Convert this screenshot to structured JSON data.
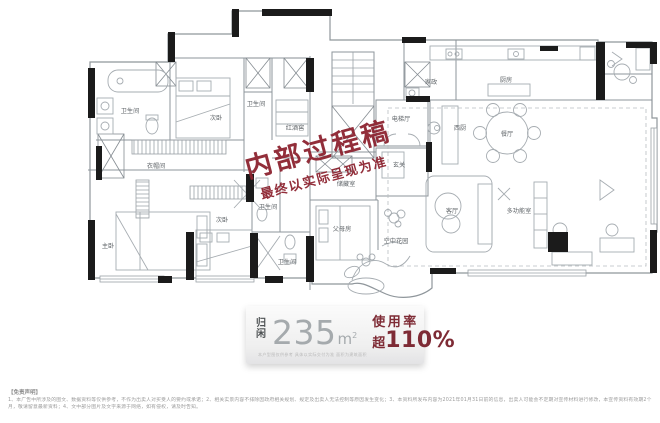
{
  "floorplan": {
    "rooms": [
      {
        "label": "卫生间",
        "x": 130,
        "y": 113
      },
      {
        "label": "次卧",
        "x": 216,
        "y": 120
      },
      {
        "label": "卫生间",
        "x": 256,
        "y": 106
      },
      {
        "label": "红酒窖",
        "x": 295,
        "y": 130
      },
      {
        "label": "电梯厅",
        "x": 401,
        "y": 121
      },
      {
        "label": "家政",
        "x": 431,
        "y": 84
      },
      {
        "label": "厨房",
        "x": 506,
        "y": 82
      },
      {
        "label": "西厨",
        "x": 460,
        "y": 130
      },
      {
        "label": "餐厅",
        "x": 507,
        "y": 136
      },
      {
        "label": "玄关",
        "x": 399,
        "y": 167
      },
      {
        "label": "储藏室",
        "x": 346,
        "y": 186
      },
      {
        "label": "衣帽间",
        "x": 156,
        "y": 168
      },
      {
        "label": "主卧",
        "x": 108,
        "y": 248
      },
      {
        "label": "次卧",
        "x": 222,
        "y": 222
      },
      {
        "label": "卫生间",
        "x": 268,
        "y": 209
      },
      {
        "label": "卫生间",
        "x": 287,
        "y": 264
      },
      {
        "label": "父母房",
        "x": 342,
        "y": 231
      },
      {
        "label": "空中花园",
        "x": 396,
        "y": 243
      },
      {
        "label": "客厅",
        "x": 452,
        "y": 213
      },
      {
        "label": "多功能室",
        "x": 519,
        "y": 213
      }
    ]
  },
  "watermark": {
    "line1": "内部过程稿",
    "line2": "最终以实际呈现为准",
    "color": "#8d2330"
  },
  "badge": {
    "name_vertical": "归闲",
    "area_value": "235",
    "area_unit": "m",
    "area_sup": "2",
    "fine_print": "本户型图仅供参考 具体以实际交付为准 面积为建筑面积",
    "usage_label": "使用率",
    "usage_prefix": "超",
    "usage_value": "110%",
    "accent_color": "#7e2b35"
  },
  "disclaimer": {
    "heading": "【免责声明】",
    "body": "1、本广告中所涉及的图文、数据资料等仅供参考，不作为出卖人对买受人的要约或承诺；2、相关实景内容不排除因政府相关规划、规定及出卖人无法控制等原因发生变化；3、本资料所发布内容为2021年01月31日前的信息，出卖人可能会不定期对宣传材料进行修改，本宣传资料有效期2个月，敬请留意最新资料；4、文中部分图片及文字来源于网络，如有侵权，请及时告知。"
  }
}
